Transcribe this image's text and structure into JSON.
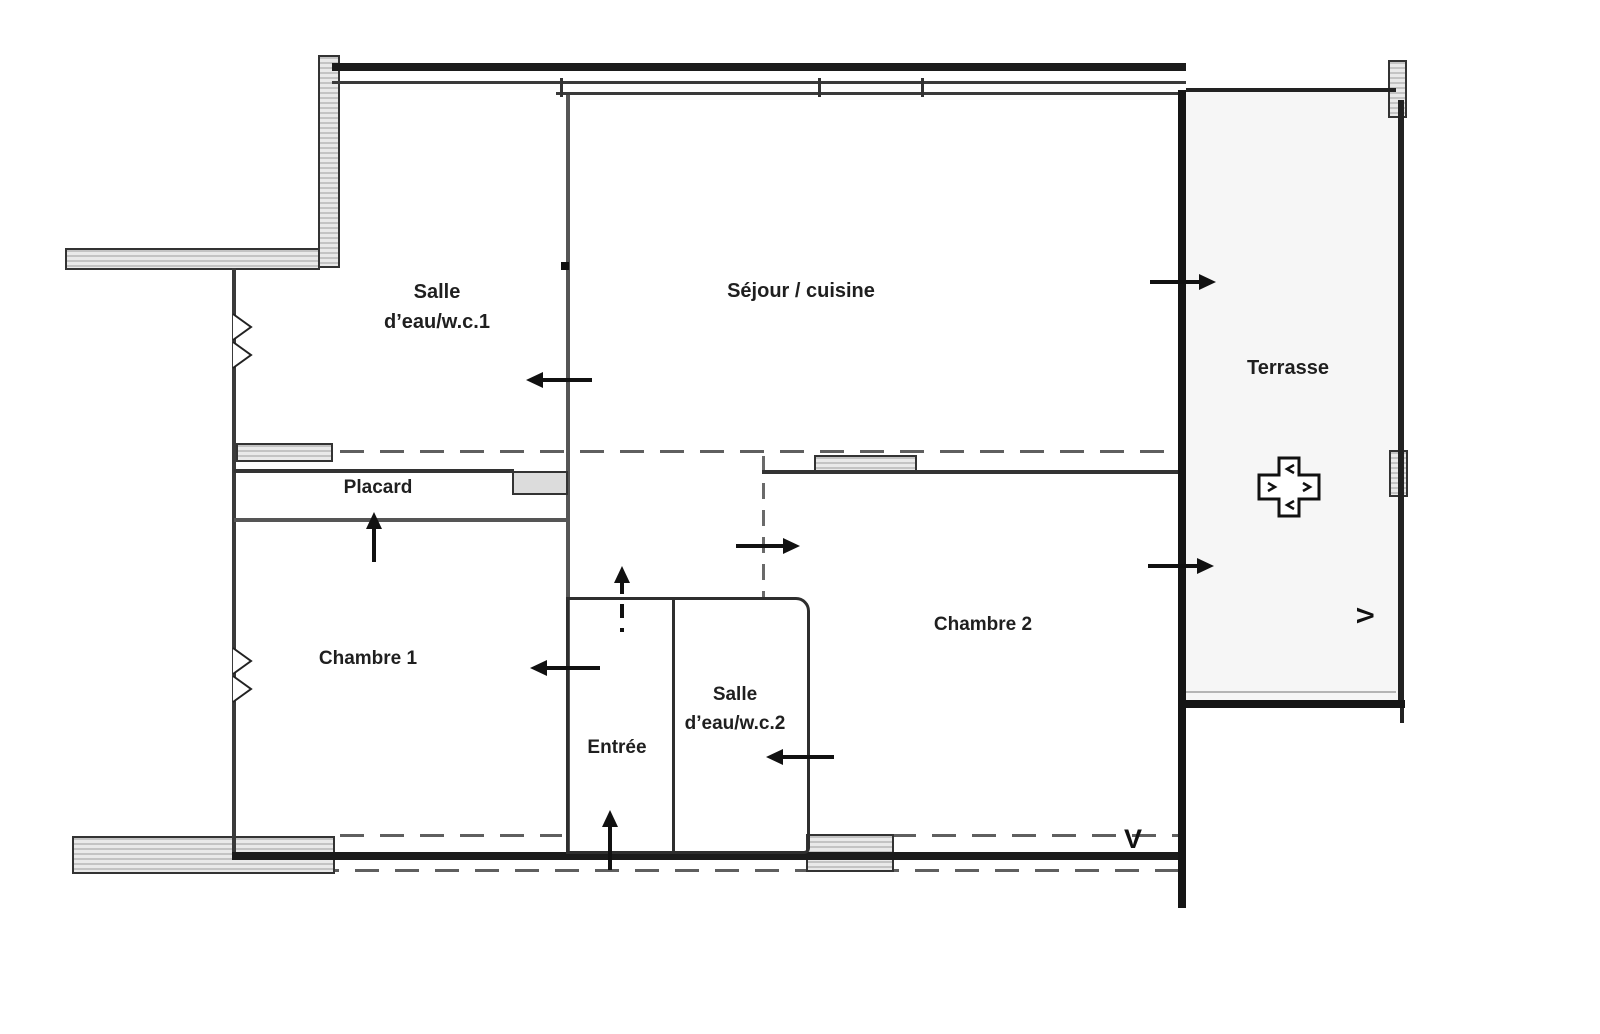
{
  "rooms": [
    {
      "key": "salle_eau_1",
      "line1": "Salle",
      "line2": "d’eau/w.c.1"
    },
    {
      "key": "sejour_cuisine",
      "label": "Séjour / cuisine"
    },
    {
      "key": "terrasse",
      "label": "Terrasse"
    },
    {
      "key": "placard",
      "label": "Placard"
    },
    {
      "key": "chambre_1",
      "label": "Chambre 1"
    },
    {
      "key": "chambre_2",
      "label": "Chambre 2"
    },
    {
      "key": "entree",
      "label": "Entrée"
    },
    {
      "key": "salle_eau_2",
      "line1": "Salle",
      "line2": "d’eau/w.c.2"
    }
  ],
  "symbols": {
    "vent_bottom": "V",
    "vent_right": "V"
  },
  "icons": [
    "door-arrow-icon",
    "window-chevron-icon",
    "column-cross-icon",
    "vent-v-icon"
  ],
  "colors": {
    "wall_dark": "#1b1b1b",
    "wall_gray": "#555555",
    "wall_mid": "#333333",
    "dash_line": "#5f5f5f",
    "hatch_fill": "#e4e4e4",
    "hatch_stripe": "#c3c3c3",
    "hatch_border": "#333333",
    "arrow": "#111111",
    "terrace_floor": "#f6f6f6",
    "duct_fill": "#dcdcdc",
    "label_text": "#1f1f1f",
    "background": "#ffffff"
  }
}
